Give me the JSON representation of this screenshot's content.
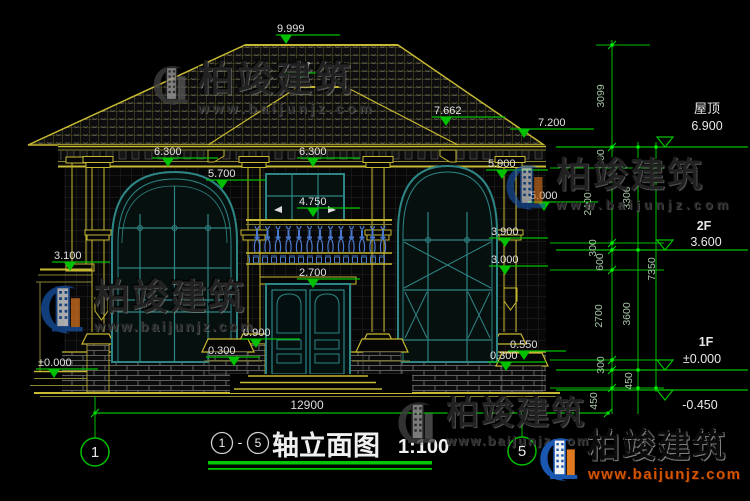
{
  "title": {
    "axis_from": "1",
    "dash": "-",
    "axis_to": "5",
    "text": "轴立面图",
    "scale": "1:100"
  },
  "axes": {
    "left": "1",
    "right": "5"
  },
  "dims": {
    "total_width": "12900",
    "inner": [
      "3099",
      "600",
      "2400",
      "300",
      "600",
      "2700",
      "300",
      "450"
    ],
    "mid": [
      "3300",
      "3600",
      "450"
    ],
    "outer": [
      "7350"
    ]
  },
  "levels": {
    "roof_label": "屋顶",
    "roof_value": "6.900",
    "f2_label": "2F",
    "f2_value": "3.600",
    "f1_label": "1F",
    "f1_value": "±0.000",
    "below_value": "-0.450"
  },
  "markers": [
    {
      "v": "9.999"
    },
    {
      "v": "8.857"
    },
    {
      "v": "7.662"
    },
    {
      "v": "7.200"
    },
    {
      "v": "6.300"
    },
    {
      "v": "5.700"
    },
    {
      "v": "6.300"
    },
    {
      "v": "5.900"
    },
    {
      "v": "5.000"
    },
    {
      "v": "4.750"
    },
    {
      "v": "3.900"
    },
    {
      "v": "3.100"
    },
    {
      "v": "3.000"
    },
    {
      "v": "2.700"
    },
    {
      "v": "0.900"
    },
    {
      "v": "0.300"
    },
    {
      "v": "0.550"
    },
    {
      "v": "0.300"
    },
    {
      "v": "±0.000"
    }
  ],
  "brand": {
    "name": "柏竣建筑",
    "url": "www.baijunjz.com"
  },
  "colors": {
    "dim_green": "#00c000",
    "structure_yellow": "#c7b832",
    "window_teal": "#2e8585",
    "baluster_blue": "#4a7ad0",
    "logo_blue": "#1a57b0",
    "logo_orange": "#e07820",
    "wm_url_orange": "#d35400"
  }
}
